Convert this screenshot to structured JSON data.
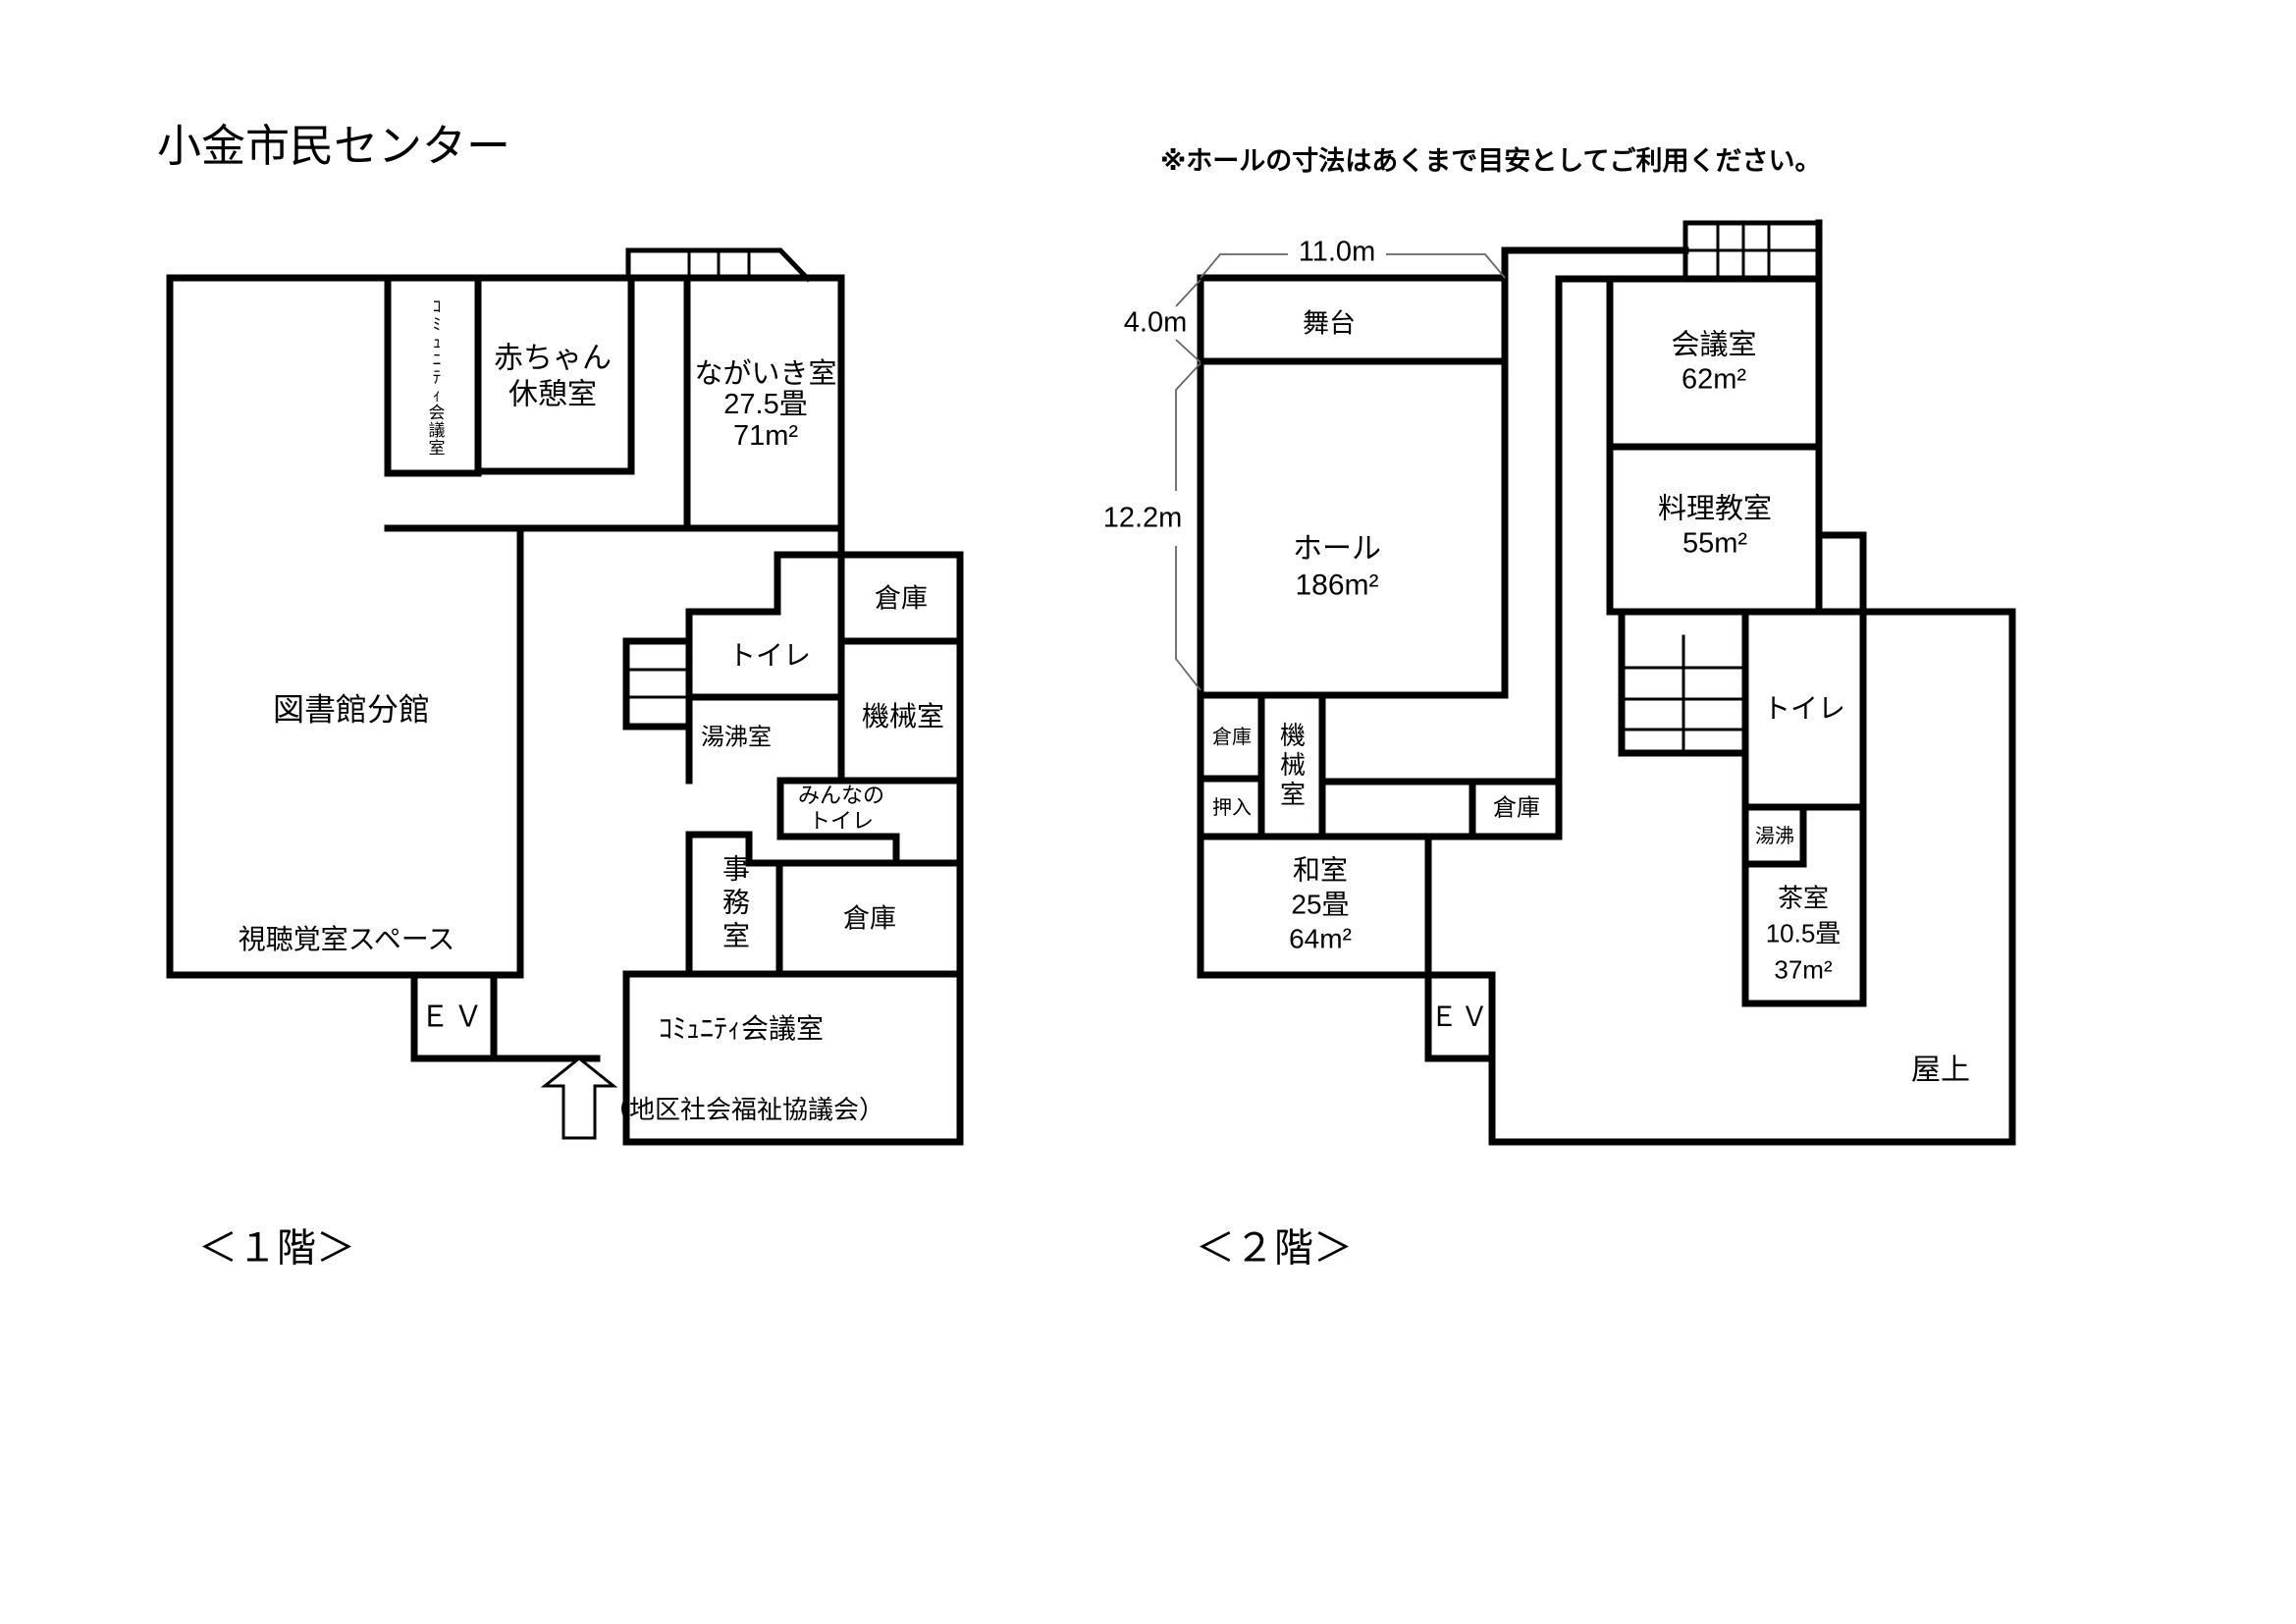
{
  "title": "小金市民センター",
  "note": "※ホールの寸法はあくまで目安としてご利用ください。",
  "f1": {
    "caption": "＜１階＞",
    "community_small": "ｺﾐｭﾆﾃｨ会議室",
    "baby_rest": "赤ちゃん\n休憩室",
    "nagaiki": "ながいき室\n27.5畳\n71m²",
    "library": "図書館分館",
    "av_space": "視聴覚室スペース",
    "toilet": "トイレ",
    "storage_top": "倉庫",
    "machine": "機械室",
    "hot_water": "湯沸室",
    "everyone_toilet": "みんなの\nトイレ",
    "office": "事務室",
    "storage_bottom": "倉庫",
    "ev": "ＥＶ",
    "community_meeting": "ｺﾐｭﾆﾃｨ会議室",
    "council": "（地区社会福祉協議会）"
  },
  "f2": {
    "caption": "＜２階＞",
    "dim_width": "11.0m",
    "dim_stage": "4.0m",
    "dim_hall": "12.2m",
    "stage": "舞台",
    "hall": "ホール\n186m²",
    "meeting": "会議室\n62m²",
    "cooking": "料理教室\n55m²",
    "storage_a": "倉庫",
    "machine": "機械室",
    "oshiire": "押入",
    "storage_b": "倉庫",
    "washitsu": "和室\n25畳\n64m²",
    "toilet": "トイレ",
    "yuwakashi": "湯沸",
    "tea_room": "茶室\n10.5畳\n37m²",
    "ev": "ＥＶ",
    "roof": "屋上"
  }
}
